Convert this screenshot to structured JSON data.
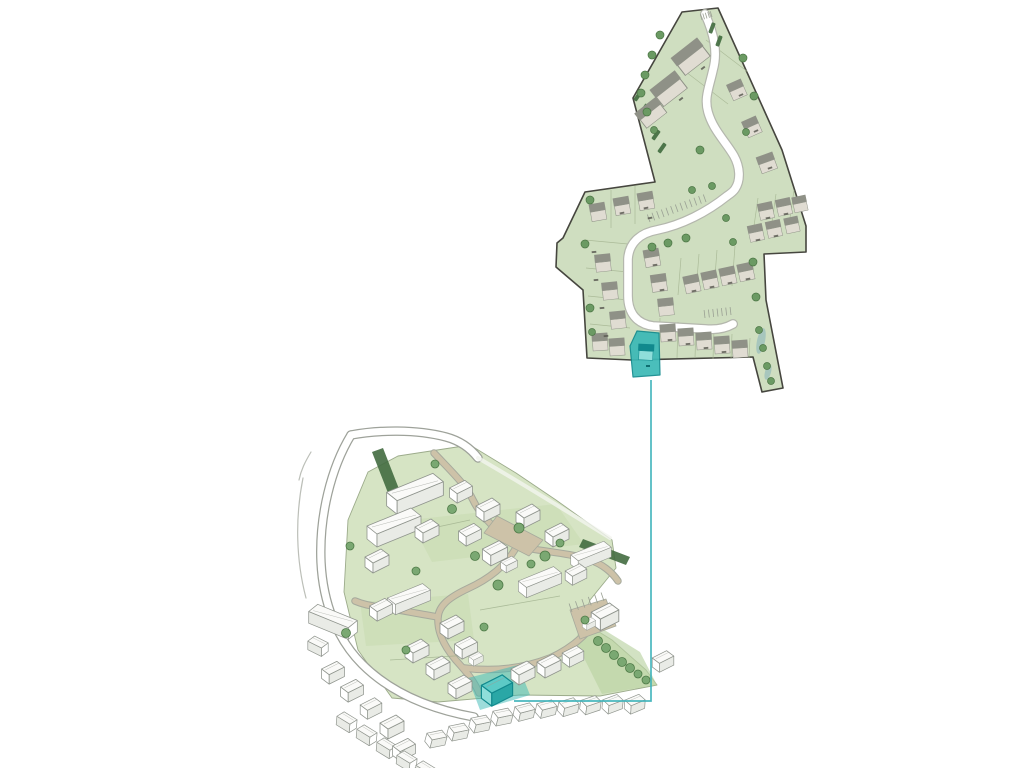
{
  "canvas": {
    "w": 1024,
    "h": 768
  },
  "colors": {
    "lawn": "#cfdec0",
    "roof": "#8f9187",
    "wall": "#e0dcd2",
    "road_casing": "#b4b7ad",
    "white_road": "#ffffff",
    "pline": "#a7b794",
    "tree": "#6b9a63",
    "tree_dark": "#4b7544",
    "hedge": "#426c40",
    "label": "#5c5c54",
    "pond": "#a2c3bc",
    "outline2d": "#46463f",
    "lawn3": "#d6e4c4",
    "lawn3b": "#c8dbb1",
    "lawn3c": "#bad3a3",
    "tan": "#cdc2a8",
    "tan_casing": "#a6aa9d",
    "outline3": "#8f948d",
    "face_top": "#fafaf8",
    "face_right": "#e9ebe6",
    "face_left": "#ffffff",
    "tree3": "#7aa872",
    "tree3_dark": "#4e7a47",
    "highlight": "#3bb9b6",
    "highlight_dark": "#11898d",
    "highlight_top": "#5ccac6",
    "highlight_right": "#2aa7a6",
    "highlight_left": "#8fdeda",
    "connector": "#3fb3ba"
  },
  "plan2d": {
    "boundary": "682,12 718,8 782,150 806,226 806,252 764,254 766,300 783,388 762,392 753,357 632,360 587,358 583,290 556,267 557,243 563,238 585,192 655,182 633,98",
    "roads": [
      "M705,14 C714,34 718,52 713,70 C709,88 704,98 708,112 C713,130 726,142 734,156 C740,167 741,180 735,189 C733,192 730,194 727,196",
      "M727,196 C707,212 682,225 657,230 C640,233 629,243 628,259 L628,296 C628,313 637,324 653,326 L705,329 C716,330 726,328 733,324"
    ],
    "ladders": [
      [
        650,
        222,
        706,
        202,
        12,
        8
      ],
      [
        705,
        318,
        731,
        315,
        6,
        8
      ],
      [
        702,
        20,
        712,
        17,
        4,
        6
      ]
    ],
    "hedges": [
      [
        712,
        28,
        -70
      ],
      [
        719,
        41,
        -70
      ],
      [
        638,
        96,
        -55
      ],
      [
        644,
        109,
        -55
      ],
      [
        650,
        122,
        -55
      ],
      [
        656,
        135,
        -55
      ],
      [
        662,
        148,
        -55
      ]
    ],
    "ponds": [
      [
        761,
        341,
        4,
        13,
        12
      ],
      [
        768,
        372,
        3,
        8,
        15
      ]
    ],
    "houses": [
      [
        691,
        57,
        -38,
        2.1,
        1.3
      ],
      [
        669,
        89,
        -38,
        2.0,
        1.25
      ],
      [
        651,
        113,
        -38,
        1.7,
        1.1
      ],
      [
        737,
        90,
        -24,
        1,
        1
      ],
      [
        752,
        127,
        -24,
        1,
        1
      ],
      [
        767,
        163,
        -20,
        1.1,
        1
      ],
      [
        598,
        212,
        -10,
        1,
        1
      ],
      [
        622,
        206,
        -10,
        1,
        1
      ],
      [
        646,
        201,
        -10,
        1,
        1
      ],
      [
        603,
        263,
        -6,
        1,
        1
      ],
      [
        610,
        291,
        -6,
        1,
        1
      ],
      [
        618,
        320,
        -6,
        1,
        1
      ],
      [
        600,
        342,
        -4,
        1,
        1
      ],
      [
        617,
        347,
        -4,
        1,
        1
      ],
      [
        652,
        258,
        -10,
        1,
        1
      ],
      [
        659,
        283,
        -8,
        1,
        1
      ],
      [
        666,
        307,
        -6,
        1,
        1
      ],
      [
        692,
        284,
        -12,
        1,
        1
      ],
      [
        710,
        280,
        -12,
        1,
        1
      ],
      [
        728,
        276,
        -12,
        1,
        1
      ],
      [
        746,
        272,
        -12,
        1,
        1
      ],
      [
        668,
        333,
        -4,
        1,
        1
      ],
      [
        686,
        337,
        -4,
        1,
        1
      ],
      [
        704,
        341,
        -4,
        1,
        1
      ],
      [
        722,
        345,
        -4,
        1,
        1
      ],
      [
        740,
        349,
        -4,
        1,
        1
      ],
      [
        766,
        211,
        -12,
        0.95,
        0.95
      ],
      [
        784,
        207,
        -12,
        0.95,
        0.95
      ],
      [
        800,
        204,
        -12,
        0.9,
        0.9
      ],
      [
        756,
        233,
        -12,
        0.95,
        0.95
      ],
      [
        774,
        229,
        -12,
        0.95,
        0.95
      ],
      [
        792,
        225,
        -12,
        0.9,
        0.9
      ]
    ],
    "trees": [
      [
        660,
        35,
        4
      ],
      [
        652,
        55,
        4
      ],
      [
        645,
        75,
        4
      ],
      [
        641,
        93,
        4
      ],
      [
        647,
        112,
        4
      ],
      [
        654,
        130,
        3.5
      ],
      [
        700,
        150,
        4
      ],
      [
        743,
        58,
        4
      ],
      [
        754,
        96,
        4
      ],
      [
        746,
        132,
        3.5
      ],
      [
        692,
        190,
        3.5
      ],
      [
        712,
        186,
        3.5
      ],
      [
        652,
        247,
        4
      ],
      [
        668,
        243,
        4
      ],
      [
        686,
        238,
        4
      ],
      [
        590,
        200,
        4
      ],
      [
        585,
        244,
        4
      ],
      [
        590,
        308,
        4
      ],
      [
        592,
        332,
        3.5
      ],
      [
        753,
        262,
        4
      ],
      [
        756,
        297,
        4
      ],
      [
        759,
        330,
        3.5
      ],
      [
        763,
        348,
        3.5
      ],
      [
        767,
        366,
        3.5
      ],
      [
        771,
        381,
        3.5
      ],
      [
        726,
        218,
        3.5
      ],
      [
        733,
        242,
        3.5
      ]
    ],
    "plines": [
      [
        585,
        240,
        628,
        244
      ],
      [
        586,
        268,
        628,
        272
      ],
      [
        588,
        296,
        628,
        300
      ],
      [
        590,
        324,
        630,
        328
      ],
      [
        611,
        190,
        611,
        228
      ],
      [
        635,
        186,
        635,
        224
      ],
      [
        681,
        258,
        678,
        295
      ],
      [
        699,
        254,
        696,
        292
      ],
      [
        717,
        250,
        714,
        289
      ],
      [
        735,
        246,
        732,
        286
      ],
      [
        660,
        318,
        659,
        357
      ],
      [
        678,
        322,
        677,
        358
      ],
      [
        696,
        326,
        695,
        358
      ],
      [
        714,
        330,
        713,
        359
      ],
      [
        732,
        334,
        731,
        359
      ],
      [
        750,
        338,
        749,
        358
      ],
      [
        758,
        198,
        752,
        240
      ],
      [
        776,
        194,
        770,
        236
      ],
      [
        794,
        190,
        788,
        232
      ],
      [
        706,
        40,
        748,
        72
      ],
      [
        686,
        72,
        728,
        104
      ]
    ],
    "labels": [
      [
        594,
        252,
        -6
      ],
      [
        596,
        280,
        -6
      ],
      [
        602,
        308,
        -6
      ],
      [
        606,
        336,
        -4
      ],
      [
        650,
        218,
        -10
      ],
      [
        622,
        213,
        -10
      ],
      [
        646,
        208,
        -10
      ],
      [
        655,
        265,
        -8
      ],
      [
        662,
        290,
        -8
      ],
      [
        694,
        291,
        -12
      ],
      [
        712,
        287,
        -12
      ],
      [
        730,
        283,
        -12
      ],
      [
        748,
        279,
        -12
      ],
      [
        670,
        340,
        -4
      ],
      [
        688,
        344,
        -4
      ],
      [
        706,
        348,
        -4
      ],
      [
        724,
        352,
        -4
      ],
      [
        768,
        218,
        -12
      ],
      [
        786,
        214,
        -12
      ],
      [
        758,
        240,
        -12
      ],
      [
        776,
        236,
        -12
      ],
      [
        703,
        68,
        -38
      ],
      [
        681,
        99,
        -38
      ],
      [
        741,
        95,
        -24
      ],
      [
        756,
        131,
        -24
      ],
      [
        770,
        168,
        -20
      ]
    ],
    "plot": {
      "points": "637,331 659,333 660,375 633,377 630,346",
      "house": {
        "x": 646,
        "y": 352,
        "rot": 3
      },
      "label": [
        648,
        366
      ]
    }
  },
  "view3d": {
    "ground": "398,456 470,445 516,473 556,500 612,540 616,568 590,600 583,622 612,640 646,670 657,685 600,696 520,695 438,702 392,698 358,650 344,592 348,520 368,472",
    "arcs": [
      "M303,478 C295,518 296,560 306,598",
      "M311,452 C305,462 301,470 299,480"
    ],
    "roads_white": [
      "M351,435 C331,468 319,516 321,562 C323,603 337,639 362,664 C388,690 424,708 474,717",
      "M351,435 C378,430 416,429 446,437 C461,441 471,449 478,458"
    ],
    "strips": [
      {
        "points": "410,520 556,504 584,544 432,562",
        "cls": "g-strip"
      },
      {
        "points": "360,602 468,594 474,640 366,646",
        "cls": "g-strip"
      },
      {
        "points": "585,618 640,652 657,685 602,694 575,640",
        "cls": "g-strip2"
      }
    ],
    "edge_path": "M478,458 C520,482 568,512 610,538",
    "roads_tan": [
      "M434,453 C450,470 466,485 473,500 C481,517 498,532 517,546",
      "M517,546 C542,552 566,552 590,560 C602,564 612,572 618,581",
      "M517,546 C506,566 489,579 467,589 C448,598 439,606 438,617 C437,635 447,651 461,666 C469,675 476,685 479,693",
      "M438,617 C420,614 400,610 380,607 C371,606 362,604 355,601",
      "M464,668 C495,672 524,668 550,658 C566,651 580,640 590,629"
    ],
    "plaza": "497,516 543,540 529,556 484,533",
    "parking": {
      "points": "570,610 606,599 616,626 580,639",
      "ticks": [
        572,
        612,
        604,
        601,
        5,
        9
      ]
    },
    "hedges": [
      "372,452 383,448 408,512 397,516",
      "583,539 630,557 626,565 579,547"
    ],
    "plines": [
      [
        372,
        541,
        470,
        520
      ],
      [
        480,
        610,
        560,
        596
      ],
      [
        390,
        660,
        470,
        655
      ]
    ],
    "patch": "468,678 518,665 530,695 480,710",
    "houses": [
      [
        415,
        487,
        1.05,
        1,
        0,
        0
      ],
      [
        394,
        521,
        1,
        1,
        0,
        0
      ],
      [
        461,
        487,
        0.95,
        0,
        0,
        0
      ],
      [
        488,
        505,
        1,
        0,
        0,
        0
      ],
      [
        528,
        511,
        1,
        0,
        0,
        0
      ],
      [
        557,
        530,
        1,
        0,
        0,
        0
      ],
      [
        591,
        551,
        0.75,
        1,
        0,
        0
      ],
      [
        427,
        526,
        1,
        0,
        0,
        0
      ],
      [
        470,
        530,
        0.95,
        0,
        0,
        0
      ],
      [
        495,
        548,
        1.05,
        0,
        0,
        0
      ],
      [
        509,
        561,
        0.7,
        0,
        0,
        0
      ],
      [
        540,
        577,
        0.8,
        1,
        0,
        0
      ],
      [
        576,
        570,
        0.9,
        0,
        0,
        0
      ],
      [
        409,
        594,
        0.8,
        1,
        0,
        0
      ],
      [
        381,
        605,
        0.95,
        0,
        0,
        0
      ],
      [
        452,
        622,
        1,
        0,
        0,
        0
      ],
      [
        466,
        643,
        0.95,
        0,
        0,
        0
      ],
      [
        476,
        656,
        0.6,
        0,
        0,
        0
      ],
      [
        417,
        646,
        1,
        0,
        0,
        0
      ],
      [
        438,
        663,
        1,
        0,
        0,
        0
      ],
      [
        460,
        682,
        1,
        0,
        0,
        0
      ],
      [
        523,
        668,
        1,
        0,
        0,
        0
      ],
      [
        549,
        661,
        1,
        0,
        0,
        0
      ],
      [
        573,
        652,
        0.9,
        0,
        0,
        0
      ],
      [
        589,
        621,
        0.55,
        0,
        0,
        0
      ],
      [
        497,
        684,
        1.3,
        2,
        0,
        0
      ],
      [
        377,
        556,
        1,
        0,
        0,
        0
      ],
      [
        333,
        616,
        0.9,
        1,
        0,
        1
      ],
      [
        318,
        642,
        0.85,
        0,
        0,
        1
      ],
      [
        333,
        668,
        0.95,
        0,
        0,
        0
      ],
      [
        352,
        686,
        0.95,
        0,
        0,
        0
      ],
      [
        371,
        704,
        0.9,
        0,
        0,
        0
      ],
      [
        605,
        611,
        1.15,
        0,
        0,
        0
      ],
      [
        663,
        657,
        0.9,
        0,
        0,
        0
      ],
      [
        392,
        722,
        1,
        0,
        0,
        0
      ],
      [
        404,
        745,
        0.95,
        0,
        0,
        0
      ],
      [
        437,
        735,
        0.85,
        0,
        15,
        0
      ],
      [
        459,
        728,
        0.85,
        0,
        15,
        0
      ],
      [
        481,
        720,
        0.85,
        0,
        15,
        0
      ],
      [
        503,
        713,
        0.85,
        0,
        15,
        0
      ],
      [
        525,
        708,
        0.85,
        0,
        12,
        0
      ],
      [
        547,
        705,
        0.85,
        0,
        12,
        0
      ],
      [
        569,
        703,
        0.85,
        0,
        10,
        0
      ],
      [
        591,
        701,
        0.85,
        0,
        8,
        0
      ],
      [
        613,
        700,
        0.85,
        0,
        6,
        0
      ],
      [
        635,
        700,
        0.85,
        0,
        4,
        0
      ],
      [
        347,
        718,
        0.85,
        0,
        5,
        1
      ],
      [
        367,
        731,
        0.85,
        0,
        5,
        1
      ],
      [
        387,
        744,
        0.85,
        0,
        5,
        1
      ],
      [
        407,
        757,
        0.85,
        0,
        5,
        1
      ],
      [
        426,
        767,
        0.85,
        0,
        5,
        1
      ]
    ],
    "trees": [
      [
        435,
        464,
        4
      ],
      [
        452,
        509,
        4.5
      ],
      [
        519,
        528,
        5
      ],
      [
        545,
        556,
        5
      ],
      [
        475,
        556,
        4.5
      ],
      [
        498,
        585,
        5
      ],
      [
        416,
        571,
        4
      ],
      [
        350,
        546,
        4
      ],
      [
        346,
        633,
        4.5
      ],
      [
        406,
        650,
        4
      ],
      [
        484,
        627,
        4
      ],
      [
        560,
        543,
        4
      ],
      [
        531,
        564,
        4
      ],
      [
        585,
        620,
        4
      ],
      [
        598,
        641,
        4.5
      ],
      [
        606,
        648,
        4.5
      ],
      [
        614,
        655,
        4.5
      ],
      [
        622,
        662,
        4.5
      ],
      [
        630,
        668,
        4.5
      ],
      [
        638,
        674,
        4
      ],
      [
        646,
        680,
        4
      ]
    ]
  },
  "connector": {
    "points": "651,380 651,701 514,701"
  }
}
